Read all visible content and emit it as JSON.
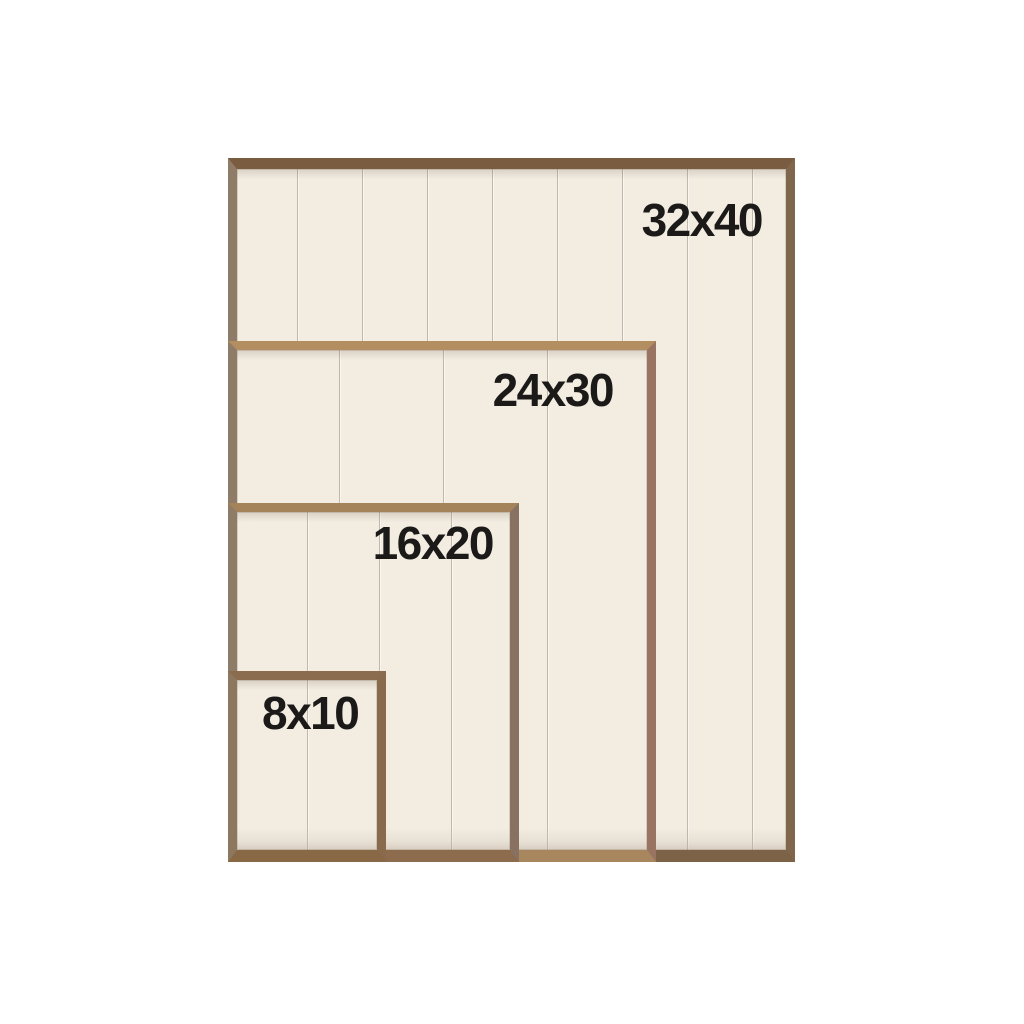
{
  "image": {
    "description": "Wood framed shiplap sign board size comparison",
    "sizes": [
      {
        "id": "32x40",
        "label": "32x40"
      },
      {
        "id": "24x30",
        "label": "24x30"
      },
      {
        "id": "16x20",
        "label": "16x20"
      },
      {
        "id": "8x10",
        "label": "8x10"
      }
    ],
    "colors": {
      "background": "#ffffff",
      "plank": "#f2ece1",
      "wood_frame": "#8a6c4e",
      "wood_frame_light": "#b38e61",
      "label_text": "#1b1a19"
    }
  }
}
